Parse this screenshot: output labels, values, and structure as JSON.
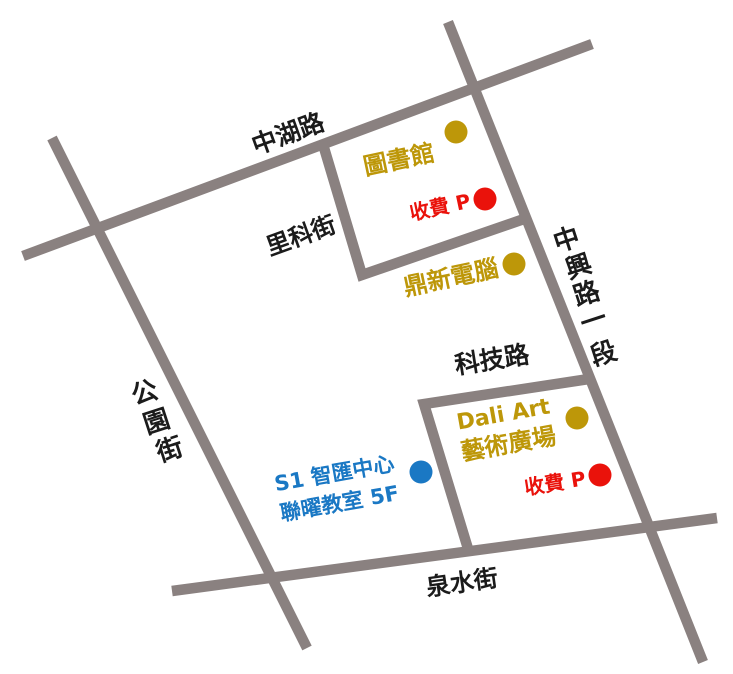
{
  "colors": {
    "background": "#ffffff",
    "road": "#8a8180",
    "poi_gold": "#bd9709",
    "poi_red": "#ea120b",
    "poi_blue": "#1a78c4",
    "road_label_black": "#1b1b1b"
  },
  "roads": {
    "zhonghu": {
      "name": "中湖路"
    },
    "gongyuan": {
      "name": "公園街",
      "chars": [
        "公",
        "園",
        "街"
      ]
    },
    "like": {
      "name": "里科街"
    },
    "zhongxing": {
      "name": "中興路一段",
      "chars": [
        "中",
        "興",
        "路",
        "一",
        "段"
      ]
    },
    "keji": {
      "name": "科技路"
    },
    "quanshui": {
      "name": "泉水街"
    }
  },
  "pois": {
    "library": {
      "label": "圖書館"
    },
    "parking_north": {
      "label": "收費 P"
    },
    "dingxin": {
      "label": "鼎新電腦"
    },
    "dali": {
      "line1": "Dali Art",
      "line2": "藝術廣場"
    },
    "s1": {
      "line1": "S1 智匯中心",
      "line2": "聯曜教室 5F"
    },
    "parking_south": {
      "label": "收費 P"
    }
  }
}
